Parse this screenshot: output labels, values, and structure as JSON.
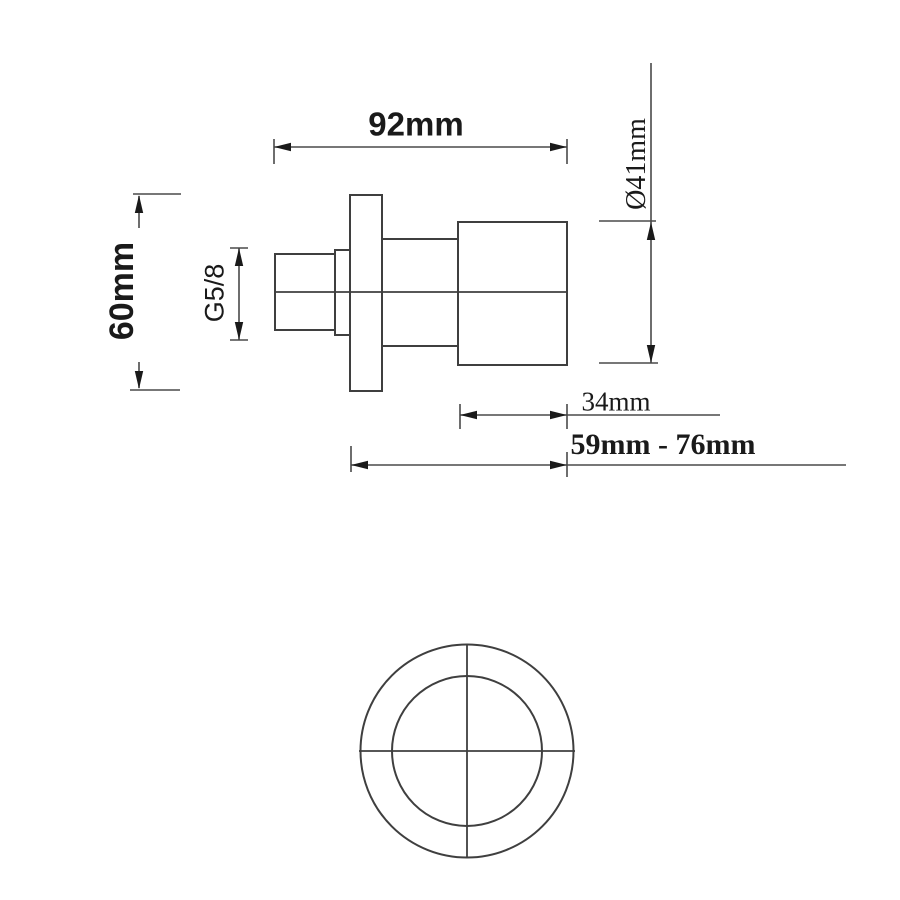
{
  "drawing": {
    "kind": "technical-dimension-drawing",
    "colors": {
      "background": "#ffffff",
      "object_line": "#3f3f3f",
      "dimension_line": "#4a4a4a",
      "arrow_and_text": "#1a1a1a"
    },
    "labels": {
      "overall_length": "92mm",
      "flange_height": "60mm",
      "thread_size": "G5/8",
      "handle_diameter": "Ø41mm",
      "handle_length": "34mm",
      "depth_range": "59mm - 76mm"
    }
  }
}
